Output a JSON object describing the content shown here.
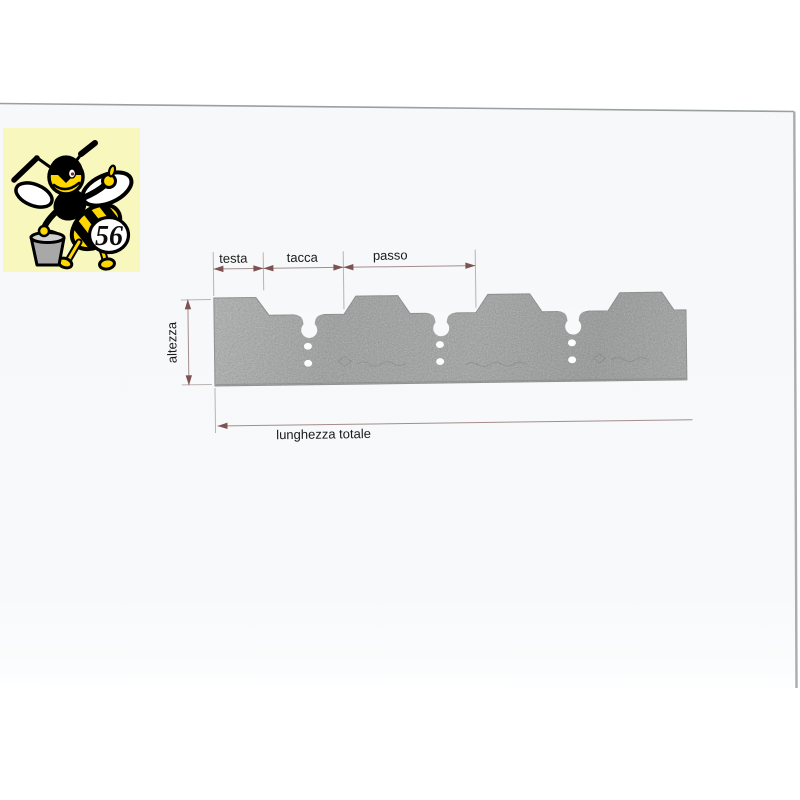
{
  "logo": {
    "number": "56",
    "background_color": "#f8f7bd",
    "bee_yellow": "#fed700"
  },
  "diagram": {
    "labels": {
      "testa": "testa",
      "tacca": "tacca",
      "passo": "passo",
      "altezza": "altezza",
      "lunghezza_totale": "lunghezza totale"
    },
    "colors": {
      "dimension_line": "#a48c8c",
      "arrowhead": "#7c5252",
      "label_text": "#1a1a1a",
      "blade_gray": "#a7a9a8",
      "sheet_background": "#f7f9fa"
    }
  }
}
